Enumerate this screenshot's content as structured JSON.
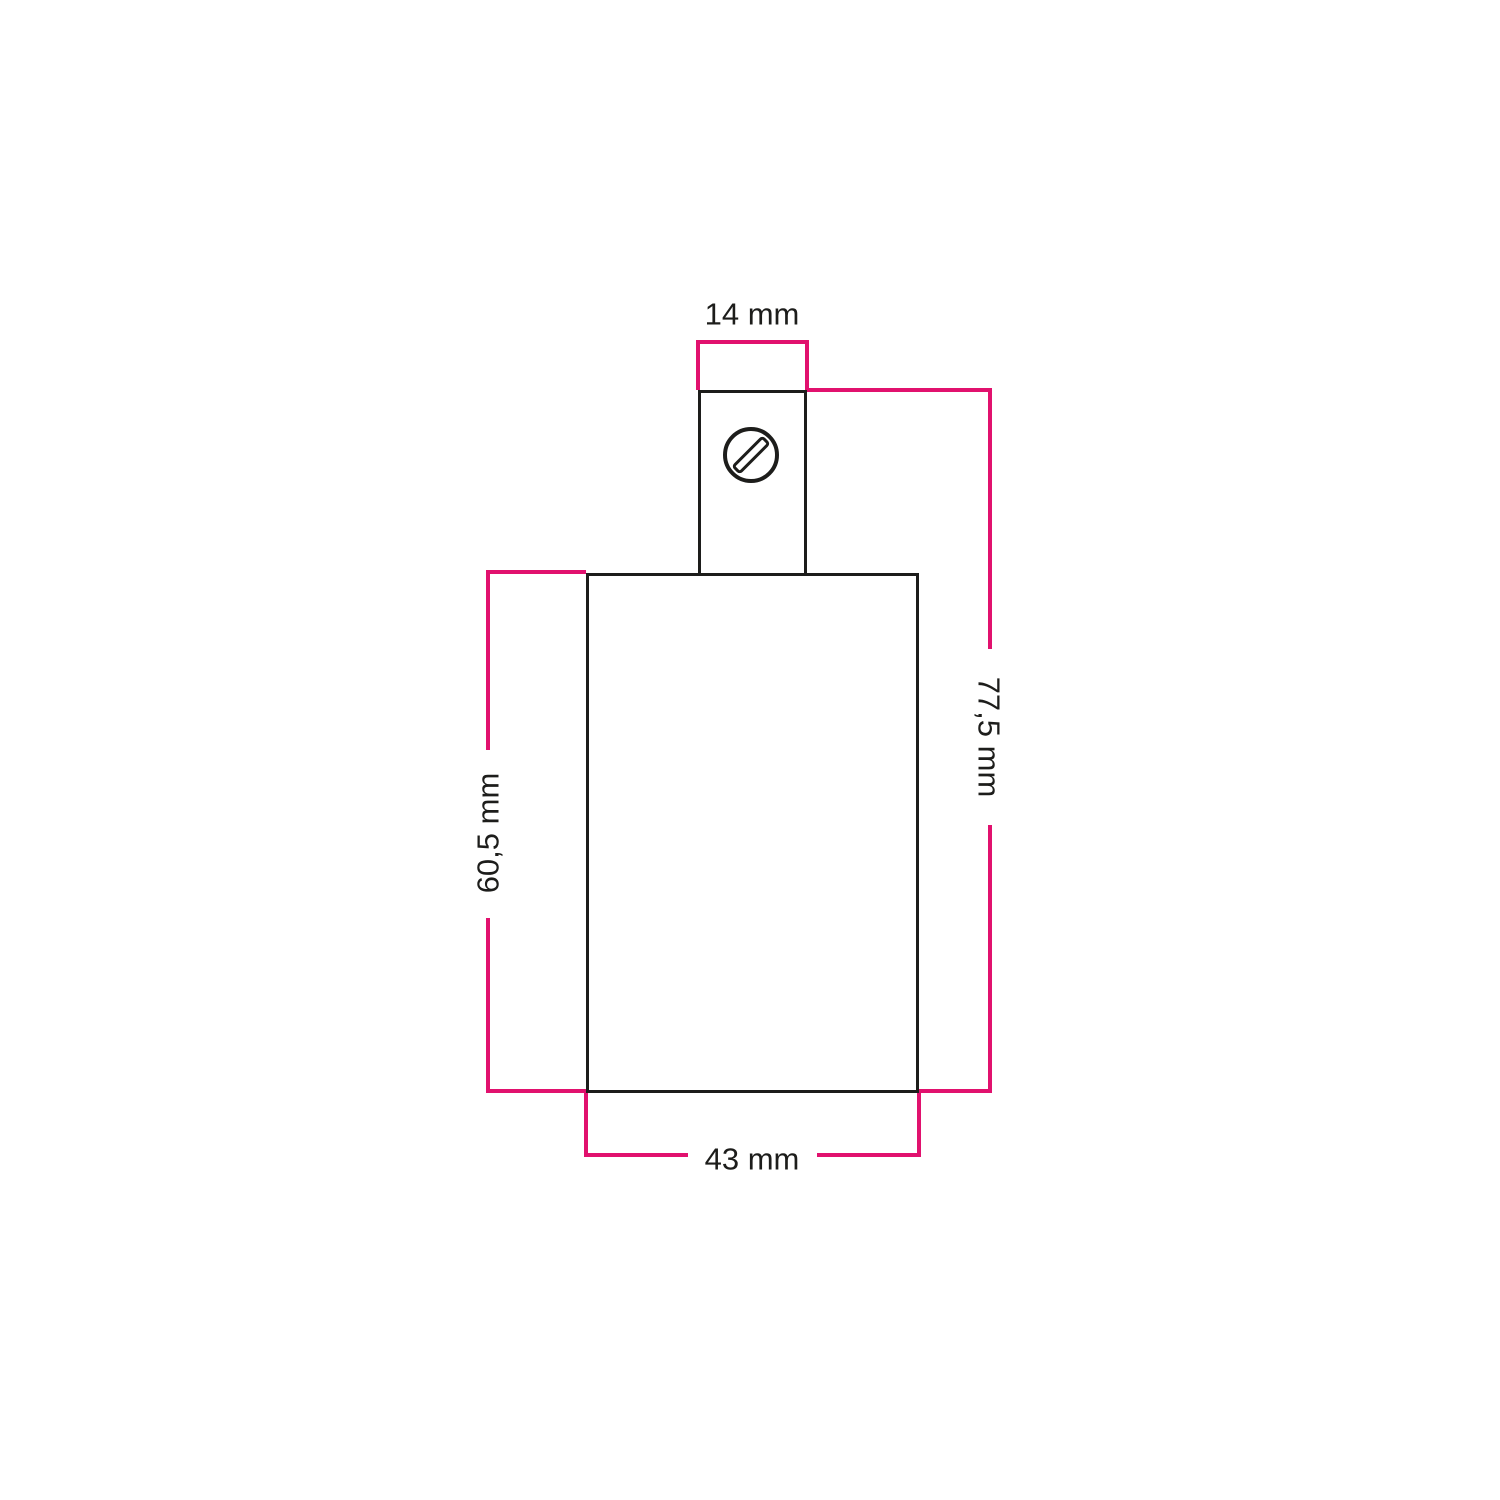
{
  "colors": {
    "accent": "#e1116e",
    "ink": "#1d1d1b",
    "background": "#ffffff"
  },
  "diagram": {
    "type": "technical-dimension-drawing",
    "unit": "mm",
    "parts": {
      "neck": "cable entry block with slotted screw",
      "body": "cylindrical lamp holder body"
    },
    "dimensions": {
      "neck_width": {
        "label": "14 mm",
        "value": 14,
        "edge": "top"
      },
      "total_height": {
        "label": "77,5 mm",
        "value": 77.5,
        "edge": "right"
      },
      "body_height": {
        "label": "60,5 mm",
        "value": 60.5,
        "edge": "left"
      },
      "body_width": {
        "label": "43 mm",
        "value": 43,
        "edge": "bottom"
      }
    }
  }
}
